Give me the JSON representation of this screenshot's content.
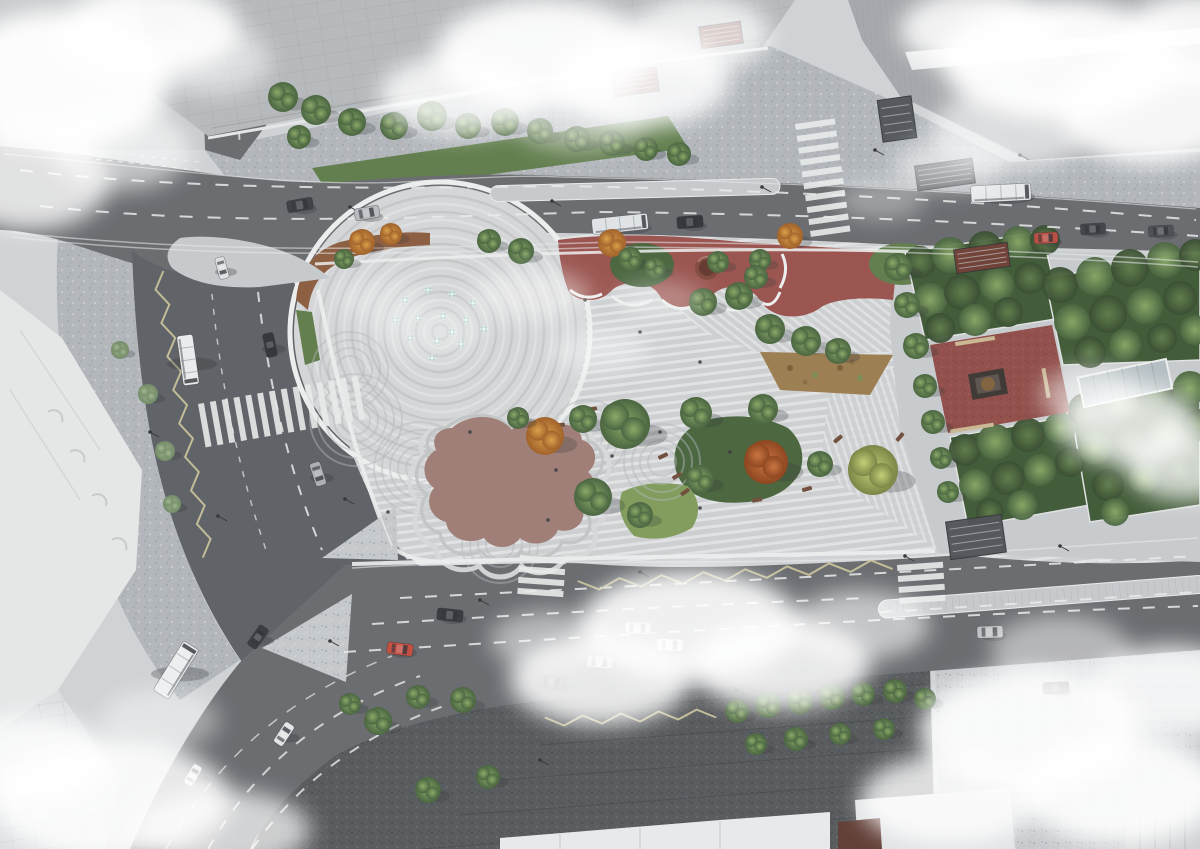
{
  "meta": {
    "title": "Aerial architectural rendering of an urban plaza and park redesign at a city intersection",
    "subject": "bird's-eye visualization with striped paving plaza, fountain circle, playgrounds, formal gardens, roads with traffic and drifting clouds"
  },
  "palette": {
    "ground": "#cfd2d4",
    "ground_light": "#c6c9cb",
    "speck_light_base": "#c3c7ca",
    "speck_dot_dark": "#989ea4",
    "speck_dot_light": "#dcdfe1",
    "speck_mid_base": "#b0b5ba",
    "speck_dark_base": "#54575a",
    "speck_dark_dot_dark": "#3e4144",
    "speck_dark_dot_light": "#6e7276",
    "road": "#65686c",
    "road_dark": "#5a5d61",
    "island": "#c5c8cb",
    "tile_line": "#a9adb1",
    "lane_white": "#e8eaea",
    "zigzag": "#cbc49a",
    "stripe_base": "#cbced0",
    "stripe_light": "#dfe1e2",
    "park_edge": "#eceeee",
    "circle_base": "#d3d5d6",
    "ring": "#bfc2c4",
    "red_playground": "#98504b",
    "red_speck_dark": "#7a3b38",
    "red_speck_light": "#aa625c",
    "red_square": "#8e4a45",
    "blob": "#9c7a72",
    "blob_terrace1": "#d5d7d8",
    "blob_terrace2": "#bfc2c3",
    "bed_orange": "#8a5a3c",
    "bed_tan": "#997a4e",
    "lawn_bright": "#7d9a58",
    "lawn_mid": "#5d7a48",
    "lawn_dark": "#46613a",
    "hedge": "#3c5732",
    "tree_green_hi": "#87a763",
    "tree_green_lo": "#44603a",
    "tree_dark_hi": "#5d7b48",
    "tree_dark_lo": "#33482b",
    "tree_orange_hi": "#d99e44",
    "tree_orange_lo": "#9e5c22",
    "tree_red_hi": "#c9703a",
    "tree_red_lo": "#8a4018",
    "tree_yellow_hi": "#c3cd74",
    "tree_yellow_lo": "#76823f",
    "tree_pale_hi": "#9eb38b",
    "tree_pale_lo": "#6f8763",
    "building_classic": "#b5b8bb",
    "building_slab": "#a2a5a9",
    "building_white": "#e4e6e7",
    "roof_white": "#e8e9ea",
    "facade_line": "#94979a",
    "stair_dark": "#4a4e52",
    "entrance_red": "#6e3a30",
    "monument_plinth": "#3a3430",
    "monument_bronze": "#7d5f39",
    "canopy": "#b3bdc1",
    "bench_brown": "#6e4a38",
    "bench_tan": "#c9b690",
    "water_jet": "#a9cdc4",
    "water_jet_hi": "#eef6f4",
    "shadow": "#2e3134",
    "cloud": "#ffffff",
    "pole": "#2f3235",
    "person": "#33363a"
  },
  "fountain": {
    "cx": 440,
    "cy": 332,
    "r_max": 146,
    "ring_step": 8
  },
  "trees": [
    [
      283,
      97,
      15,
      "g"
    ],
    [
      316,
      110,
      15,
      "g"
    ],
    [
      352,
      122,
      14,
      "g"
    ],
    [
      299,
      137,
      12,
      "g"
    ],
    [
      394,
      126,
      14,
      "g"
    ],
    [
      432,
      116,
      15,
      "g"
    ],
    [
      468,
      126,
      13,
      "g"
    ],
    [
      505,
      122,
      14,
      "g"
    ],
    [
      540,
      131,
      13,
      "g"
    ],
    [
      577,
      139,
      13,
      "g"
    ],
    [
      612,
      143,
      13,
      "g"
    ],
    [
      646,
      149,
      12,
      "g"
    ],
    [
      679,
      154,
      12,
      "g"
    ],
    [
      362,
      242,
      13,
      "o"
    ],
    [
      391,
      234,
      11,
      "o"
    ],
    [
      344,
      259,
      10,
      "g"
    ],
    [
      489,
      241,
      12,
      "g"
    ],
    [
      521,
      251,
      13,
      "g"
    ],
    [
      612,
      243,
      14,
      "o"
    ],
    [
      630,
      259,
      12,
      "g"
    ],
    [
      655,
      268,
      11,
      "g"
    ],
    [
      760,
      260,
      11,
      "g"
    ],
    [
      790,
      236,
      13,
      "o"
    ],
    [
      703,
      302,
      14,
      "g"
    ],
    [
      739,
      296,
      14,
      "g"
    ],
    [
      770,
      329,
      15,
      "g"
    ],
    [
      806,
      341,
      15,
      "g"
    ],
    [
      838,
      351,
      13,
      "g"
    ],
    [
      718,
      262,
      11,
      "g"
    ],
    [
      756,
      277,
      12,
      "g"
    ],
    [
      898,
      267,
      14,
      "g"
    ],
    [
      907,
      305,
      13,
      "g"
    ],
    [
      916,
      346,
      13,
      "g"
    ],
    [
      925,
      386,
      12,
      "g"
    ],
    [
      933,
      422,
      12,
      "g"
    ],
    [
      941,
      458,
      11,
      "g"
    ],
    [
      948,
      492,
      11,
      "g"
    ],
    [
      545,
      436,
      19,
      "o"
    ],
    [
      583,
      419,
      14,
      "g"
    ],
    [
      625,
      424,
      25,
      "g"
    ],
    [
      696,
      413,
      16,
      "g"
    ],
    [
      763,
      409,
      15,
      "g"
    ],
    [
      766,
      462,
      22,
      "r"
    ],
    [
      873,
      470,
      25,
      "y"
    ],
    [
      820,
      464,
      13,
      "g"
    ],
    [
      593,
      497,
      19,
      "g"
    ],
    [
      640,
      515,
      13,
      "g"
    ],
    [
      700,
      479,
      14,
      "g"
    ],
    [
      518,
      418,
      11,
      "g"
    ],
    [
      737,
      711,
      12,
      "g"
    ],
    [
      768,
      705,
      13,
      "g"
    ],
    [
      800,
      701,
      13,
      "g"
    ],
    [
      832,
      697,
      13,
      "g"
    ],
    [
      863,
      694,
      12,
      "g"
    ],
    [
      895,
      691,
      12,
      "g"
    ],
    [
      925,
      699,
      11,
      "g"
    ],
    [
      756,
      744,
      11,
      "g"
    ],
    [
      796,
      739,
      12,
      "g"
    ],
    [
      840,
      734,
      11,
      "g"
    ],
    [
      884,
      729,
      11,
      "g"
    ],
    [
      378,
      721,
      14,
      "g"
    ],
    [
      428,
      790,
      13,
      "g"
    ],
    [
      488,
      777,
      12,
      "g"
    ],
    [
      463,
      700,
      13,
      "g"
    ],
    [
      418,
      697,
      12,
      "g"
    ],
    [
      350,
      704,
      11,
      "g"
    ],
    [
      148,
      394,
      10,
      "p"
    ],
    [
      165,
      451,
      10,
      "p"
    ],
    [
      172,
      504,
      9,
      "p"
    ],
    [
      120,
      350,
      9,
      "p"
    ]
  ],
  "garden_clumps": [
    [
      920,
      262,
      16,
      0
    ],
    [
      950,
      255,
      18,
      1
    ],
    [
      985,
      248,
      17,
      0
    ],
    [
      1018,
      242,
      16,
      1
    ],
    [
      1045,
      240,
      15,
      0
    ],
    [
      930,
      300,
      17,
      1
    ],
    [
      962,
      292,
      18,
      0
    ],
    [
      997,
      285,
      17,
      1
    ],
    [
      1030,
      278,
      16,
      0
    ],
    [
      940,
      328,
      15,
      0
    ],
    [
      975,
      320,
      16,
      1
    ],
    [
      1008,
      312,
      15,
      0
    ],
    [
      965,
      450,
      16,
      0
    ],
    [
      995,
      442,
      18,
      1
    ],
    [
      1028,
      435,
      17,
      0
    ],
    [
      1060,
      428,
      16,
      1
    ],
    [
      975,
      485,
      16,
      1
    ],
    [
      1008,
      478,
      17,
      0
    ],
    [
      1040,
      470,
      16,
      1
    ],
    [
      1070,
      462,
      15,
      0
    ],
    [
      990,
      512,
      14,
      0
    ],
    [
      1022,
      505,
      15,
      1
    ],
    [
      1060,
      285,
      18,
      0
    ],
    [
      1095,
      276,
      19,
      1
    ],
    [
      1130,
      268,
      19,
      0
    ],
    [
      1165,
      260,
      18,
      1
    ],
    [
      1195,
      255,
      16,
      0
    ],
    [
      1072,
      322,
      18,
      1
    ],
    [
      1108,
      314,
      19,
      0
    ],
    [
      1145,
      306,
      18,
      1
    ],
    [
      1180,
      298,
      17,
      0
    ],
    [
      1090,
      352,
      16,
      0
    ],
    [
      1125,
      345,
      16,
      1
    ],
    [
      1162,
      338,
      15,
      0
    ],
    [
      1195,
      330,
      15,
      1
    ],
    [
      1085,
      410,
      17,
      0
    ],
    [
      1120,
      402,
      18,
      1
    ],
    [
      1155,
      394,
      18,
      0
    ],
    [
      1190,
      388,
      17,
      1
    ],
    [
      1095,
      448,
      17,
      1
    ],
    [
      1130,
      440,
      18,
      0
    ],
    [
      1166,
      432,
      17,
      1
    ],
    [
      1198,
      425,
      16,
      0
    ],
    [
      1108,
      485,
      16,
      0
    ],
    [
      1144,
      478,
      16,
      1
    ],
    [
      1180,
      470,
      15,
      0
    ],
    [
      1115,
      512,
      14,
      1
    ]
  ],
  "vehicles": [
    [
      300,
      205,
      -10,
      26,
      12,
      "#383b40",
      "car"
    ],
    [
      367,
      213,
      -10,
      25,
      12,
      "#b6b9bd",
      "car"
    ],
    [
      690,
      222,
      -4,
      26,
      12,
      "#2e3237",
      "car"
    ],
    [
      1046,
      238,
      -3,
      24,
      11,
      "#b54a3e",
      "car"
    ],
    [
      1093,
      229,
      -3,
      25,
      11,
      "#3c4045",
      "car"
    ],
    [
      1161,
      231,
      -3,
      25,
      11,
      "#484b50",
      "car"
    ],
    [
      620,
      224,
      -6,
      56,
      16,
      "#dfe2e4",
      "bus"
    ],
    [
      1001,
      193,
      -3,
      60,
      17,
      "#e6e8ea",
      "bus"
    ],
    [
      270,
      345,
      78,
      24,
      11,
      "#2e3135",
      "car"
    ],
    [
      318,
      474,
      72,
      24,
      11,
      "#a9adb2",
      "car"
    ],
    [
      222,
      268,
      75,
      22,
      10,
      "#dde0e2",
      "car"
    ],
    [
      188,
      360,
      82,
      50,
      16,
      "#e9ebec",
      "bus"
    ],
    [
      450,
      615,
      6,
      26,
      12,
      "#33363b",
      "car"
    ],
    [
      400,
      649,
      7,
      26,
      12,
      "#c04a3d",
      "car"
    ],
    [
      638,
      628,
      3,
      26,
      12,
      "#c6c9cc",
      "car"
    ],
    [
      670,
      645,
      3,
      26,
      12,
      "#dcdedf",
      "car"
    ],
    [
      600,
      662,
      4,
      26,
      12,
      "#b9bcbf",
      "car"
    ],
    [
      552,
      682,
      4,
      26,
      12,
      "#53575c",
      "car"
    ],
    [
      990,
      632,
      -2,
      26,
      12,
      "#bcbfc2",
      "car"
    ],
    [
      1056,
      688,
      -2,
      26,
      12,
      "#3e4146",
      "car"
    ],
    [
      258,
      637,
      -55,
      24,
      11,
      "#34373c",
      "car"
    ],
    [
      284,
      734,
      -57,
      24,
      11,
      "#e2e4e5",
      "car"
    ],
    [
      193,
      775,
      -60,
      22,
      10,
      "#dfe1e3",
      "car"
    ],
    [
      176,
      670,
      -58,
      58,
      18,
      "#eceeef",
      "bus"
    ]
  ],
  "jets": [
    [
      405,
      300
    ],
    [
      428,
      290
    ],
    [
      452,
      294
    ],
    [
      473,
      303
    ],
    [
      418,
      318
    ],
    [
      443,
      316
    ],
    [
      466,
      320
    ],
    [
      410,
      338
    ],
    [
      437,
      341
    ],
    [
      461,
      344
    ],
    [
      484,
      329
    ],
    [
      432,
      358
    ],
    [
      452,
      332
    ],
    [
      395,
      320
    ]
  ],
  "benches_small": [
    [
      592,
      409,
      -8
    ],
    [
      633,
      441,
      -20
    ],
    [
      663,
      456,
      -25
    ],
    [
      677,
      476,
      -30
    ],
    [
      685,
      492,
      -35
    ],
    [
      757,
      500,
      -10
    ],
    [
      807,
      489,
      -15
    ],
    [
      838,
      439,
      -40
    ],
    [
      860,
      468,
      -45
    ],
    [
      900,
      437,
      -50
    ],
    [
      560,
      425,
      -5
    ]
  ],
  "benches_tan": [
    [
      975,
      341,
      -9,
      40,
      4
    ],
    [
      972,
      428,
      -9,
      44,
      4
    ],
    [
      1046,
      383,
      80,
      30,
      4
    ]
  ],
  "poles": [
    [
      350,
      207
    ],
    [
      552,
      201
    ],
    [
      762,
      187
    ],
    [
      1020,
      155
    ],
    [
      875,
      150
    ],
    [
      150,
      432
    ],
    [
      218,
      516
    ],
    [
      345,
      499
    ],
    [
      480,
      600
    ],
    [
      640,
      572
    ],
    [
      905,
      556
    ],
    [
      1060,
      546
    ],
    [
      330,
      641
    ],
    [
      736,
      690
    ],
    [
      540,
      760
    ]
  ],
  "people": [
    [
      585,
      300
    ],
    [
      640,
      332
    ],
    [
      700,
      362
    ],
    [
      556,
      470
    ],
    [
      612,
      456
    ],
    [
      660,
      432
    ],
    [
      730,
      452
    ],
    [
      762,
      472
    ],
    [
      700,
      508
    ],
    [
      548,
      520
    ],
    [
      470,
      432
    ],
    [
      388,
      512
    ]
  ],
  "crosswalks": [
    {
      "x": 198,
      "y": 404,
      "rot": -10,
      "n": 14,
      "bw": 6,
      "bh": 44,
      "gap": 12,
      "vert": true
    },
    {
      "x": 795,
      "y": 124,
      "rot": -8,
      "n": 10,
      "bw": 40,
      "bh": 6,
      "gap": 12,
      "vert": false
    },
    {
      "x": 520,
      "y": 555,
      "rot": 4,
      "n": 4,
      "bw": 46,
      "bh": 6,
      "gap": 11,
      "vert": false
    },
    {
      "x": 897,
      "y": 565,
      "rot": -4,
      "n": 4,
      "bw": 46,
      "bh": 6,
      "gap": 11,
      "vert": false
    },
    {
      "x": 1124,
      "y": 18,
      "rot": -12,
      "n": 5,
      "bw": 38,
      "bh": 5,
      "gap": 9,
      "vert": false
    },
    {
      "x": 1172,
      "y": 82,
      "rot": -12,
      "n": 3,
      "bw": 30,
      "bh": 5,
      "gap": 9,
      "vert": false
    }
  ],
  "zigzags": [
    {
      "x": 158,
      "y": 272,
      "len": 290,
      "dir": 80,
      "amp": 11,
      "step": 17
    },
    {
      "x": 578,
      "y": 586,
      "len": 315,
      "dir": -4,
      "amp": 10,
      "step": 21
    },
    {
      "x": 545,
      "y": 722,
      "len": 180,
      "dir": -3,
      "amp": 9,
      "step": 19
    }
  ],
  "swirls": [
    {
      "x": 356,
      "y": 420,
      "n": 5
    },
    {
      "x": 420,
      "y": 468,
      "n": 5
    },
    {
      "x": 588,
      "y": 438,
      "n": 4
    },
    {
      "x": 662,
      "y": 462,
      "n": 4
    },
    {
      "x": 500,
      "y": 545,
      "n": 4
    },
    {
      "x": 350,
      "y": 370,
      "n": 4
    }
  ],
  "stairs": [
    [
      880,
      98,
      34,
      42,
      -8,
      "stair_dark"
    ],
    [
      916,
      162,
      58,
      25,
      -8,
      "stair_dark"
    ],
    [
      612,
      70,
      46,
      24,
      -8,
      "entrance_red"
    ],
    [
      700,
      24,
      42,
      22,
      -8,
      "entrance_red"
    ],
    [
      955,
      246,
      54,
      24,
      -8,
      "entrance_red"
    ],
    [
      948,
      518,
      56,
      38,
      -8,
      "stair_dark"
    ]
  ],
  "clouds": [
    [
      545,
      55,
      110,
      55,
      0.92
    ],
    [
      640,
      80,
      90,
      48,
      0.85
    ],
    [
      460,
      95,
      80,
      40,
      0.8
    ],
    [
      700,
      35,
      70,
      38,
      0.75
    ],
    [
      580,
      120,
      70,
      30,
      0.5
    ],
    [
      60,
      80,
      110,
      70,
      0.95
    ],
    [
      150,
      30,
      90,
      45,
      0.9
    ],
    [
      30,
      180,
      80,
      50,
      0.8
    ],
    [
      120,
      150,
      70,
      40,
      0.6
    ],
    [
      210,
      60,
      60,
      35,
      0.5
    ],
    [
      1060,
      60,
      120,
      60,
      0.95
    ],
    [
      1150,
      110,
      90,
      55,
      0.9
    ],
    [
      980,
      30,
      80,
      40,
      0.85
    ],
    [
      1190,
      40,
      70,
      45,
      0.9
    ],
    [
      1010,
      130,
      80,
      40,
      0.6
    ],
    [
      1130,
      425,
      70,
      40,
      0.8
    ],
    [
      1185,
      465,
      60,
      35,
      0.75
    ],
    [
      1090,
      395,
      50,
      28,
      0.5
    ],
    [
      530,
      295,
      60,
      25,
      0.45
    ],
    [
      600,
      350,
      50,
      22,
      0.4
    ],
    [
      660,
      300,
      45,
      20,
      0.3
    ],
    [
      430,
      330,
      55,
      25,
      0.35
    ],
    [
      690,
      625,
      110,
      55,
      0.9
    ],
    [
      600,
      680,
      90,
      45,
      0.85
    ],
    [
      780,
      665,
      90,
      45,
      0.85
    ],
    [
      860,
      625,
      70,
      35,
      0.6
    ],
    [
      550,
      640,
      60,
      30,
      0.5
    ],
    [
      1030,
      730,
      110,
      60,
      0.9
    ],
    [
      1120,
      790,
      100,
      55,
      0.9
    ],
    [
      1170,
      690,
      80,
      45,
      0.8
    ],
    [
      950,
      800,
      90,
      45,
      0.8
    ],
    [
      1060,
      650,
      70,
      35,
      0.5
    ],
    [
      110,
      800,
      120,
      60,
      0.85
    ],
    [
      30,
      760,
      80,
      45,
      0.8
    ],
    [
      220,
      830,
      90,
      40,
      0.7
    ],
    [
      160,
      720,
      60,
      30,
      0.4
    ],
    [
      950,
      165,
      55,
      25,
      0.55
    ],
    [
      880,
      200,
      45,
      20,
      0.35
    ],
    [
      380,
      300,
      45,
      22,
      0.3
    ]
  ]
}
